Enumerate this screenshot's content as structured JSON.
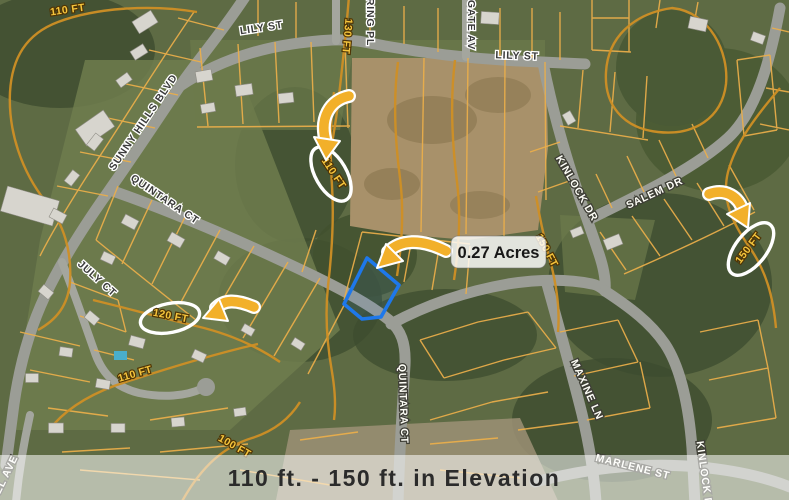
{
  "map": {
    "streets": [
      {
        "name": "lily-st-west",
        "label": "LILY ST"
      },
      {
        "name": "lily-st-east",
        "label": "LILY ST"
      },
      {
        "name": "ring-pl",
        "label": "RING PL"
      },
      {
        "name": "gate-av",
        "label": "GATE AV"
      },
      {
        "name": "sunny-hills-blvd",
        "label": "SUNNY HILLS BLVD"
      },
      {
        "name": "quintara-ct-upper",
        "label": "QUINTARA CT"
      },
      {
        "name": "july-ct",
        "label": "JULY CT"
      },
      {
        "name": "quintara-ct-south",
        "label": "QUINTARA CT"
      },
      {
        "name": "kinlock-dr",
        "label": "KINLOCK DR"
      },
      {
        "name": "salem-dr",
        "label": "SALEM DR"
      },
      {
        "name": "maxine-ln",
        "label": "MAXINE LN"
      },
      {
        "name": "marlene-st",
        "label": "MARLENE ST"
      },
      {
        "name": "kinlock-d-lower",
        "label": "KINLOCK D"
      },
      {
        "name": "el-ave",
        "label": "EL AVE"
      }
    ],
    "contour_labels": [
      {
        "name": "contour-110-top-left",
        "label": "110 FT"
      },
      {
        "name": "contour-130-top",
        "label": "130 FT"
      },
      {
        "name": "contour-150-center",
        "label": "150 FT"
      },
      {
        "name": "contour-110-bottom-left",
        "label": "110 FT"
      },
      {
        "name": "contour-100-bottom",
        "label": "100 FT"
      }
    ]
  },
  "annotations": {
    "acreage_label": "0.27 Acres",
    "highlighted_elevations": [
      {
        "name": "elevation-oval-110",
        "label": "110 FT"
      },
      {
        "name": "elevation-oval-120",
        "label": "120 FT"
      },
      {
        "name": "elevation-oval-150",
        "label": "150 FT"
      }
    ]
  },
  "banner": {
    "text": "110 ft. - 150 ft. in Elevation"
  },
  "colors": {
    "arrow_yellow": "#F2B02A",
    "parcel_orange": "#ECAF4A",
    "contour_orange": "#CF8F25",
    "contour_label_yellow": "#F6C63D",
    "subject_parcel_blue": "#1E78EA",
    "oval_white": "#FFFFFF",
    "banner_text": "#2B2B2B",
    "road_gray": "#9B9D96"
  }
}
